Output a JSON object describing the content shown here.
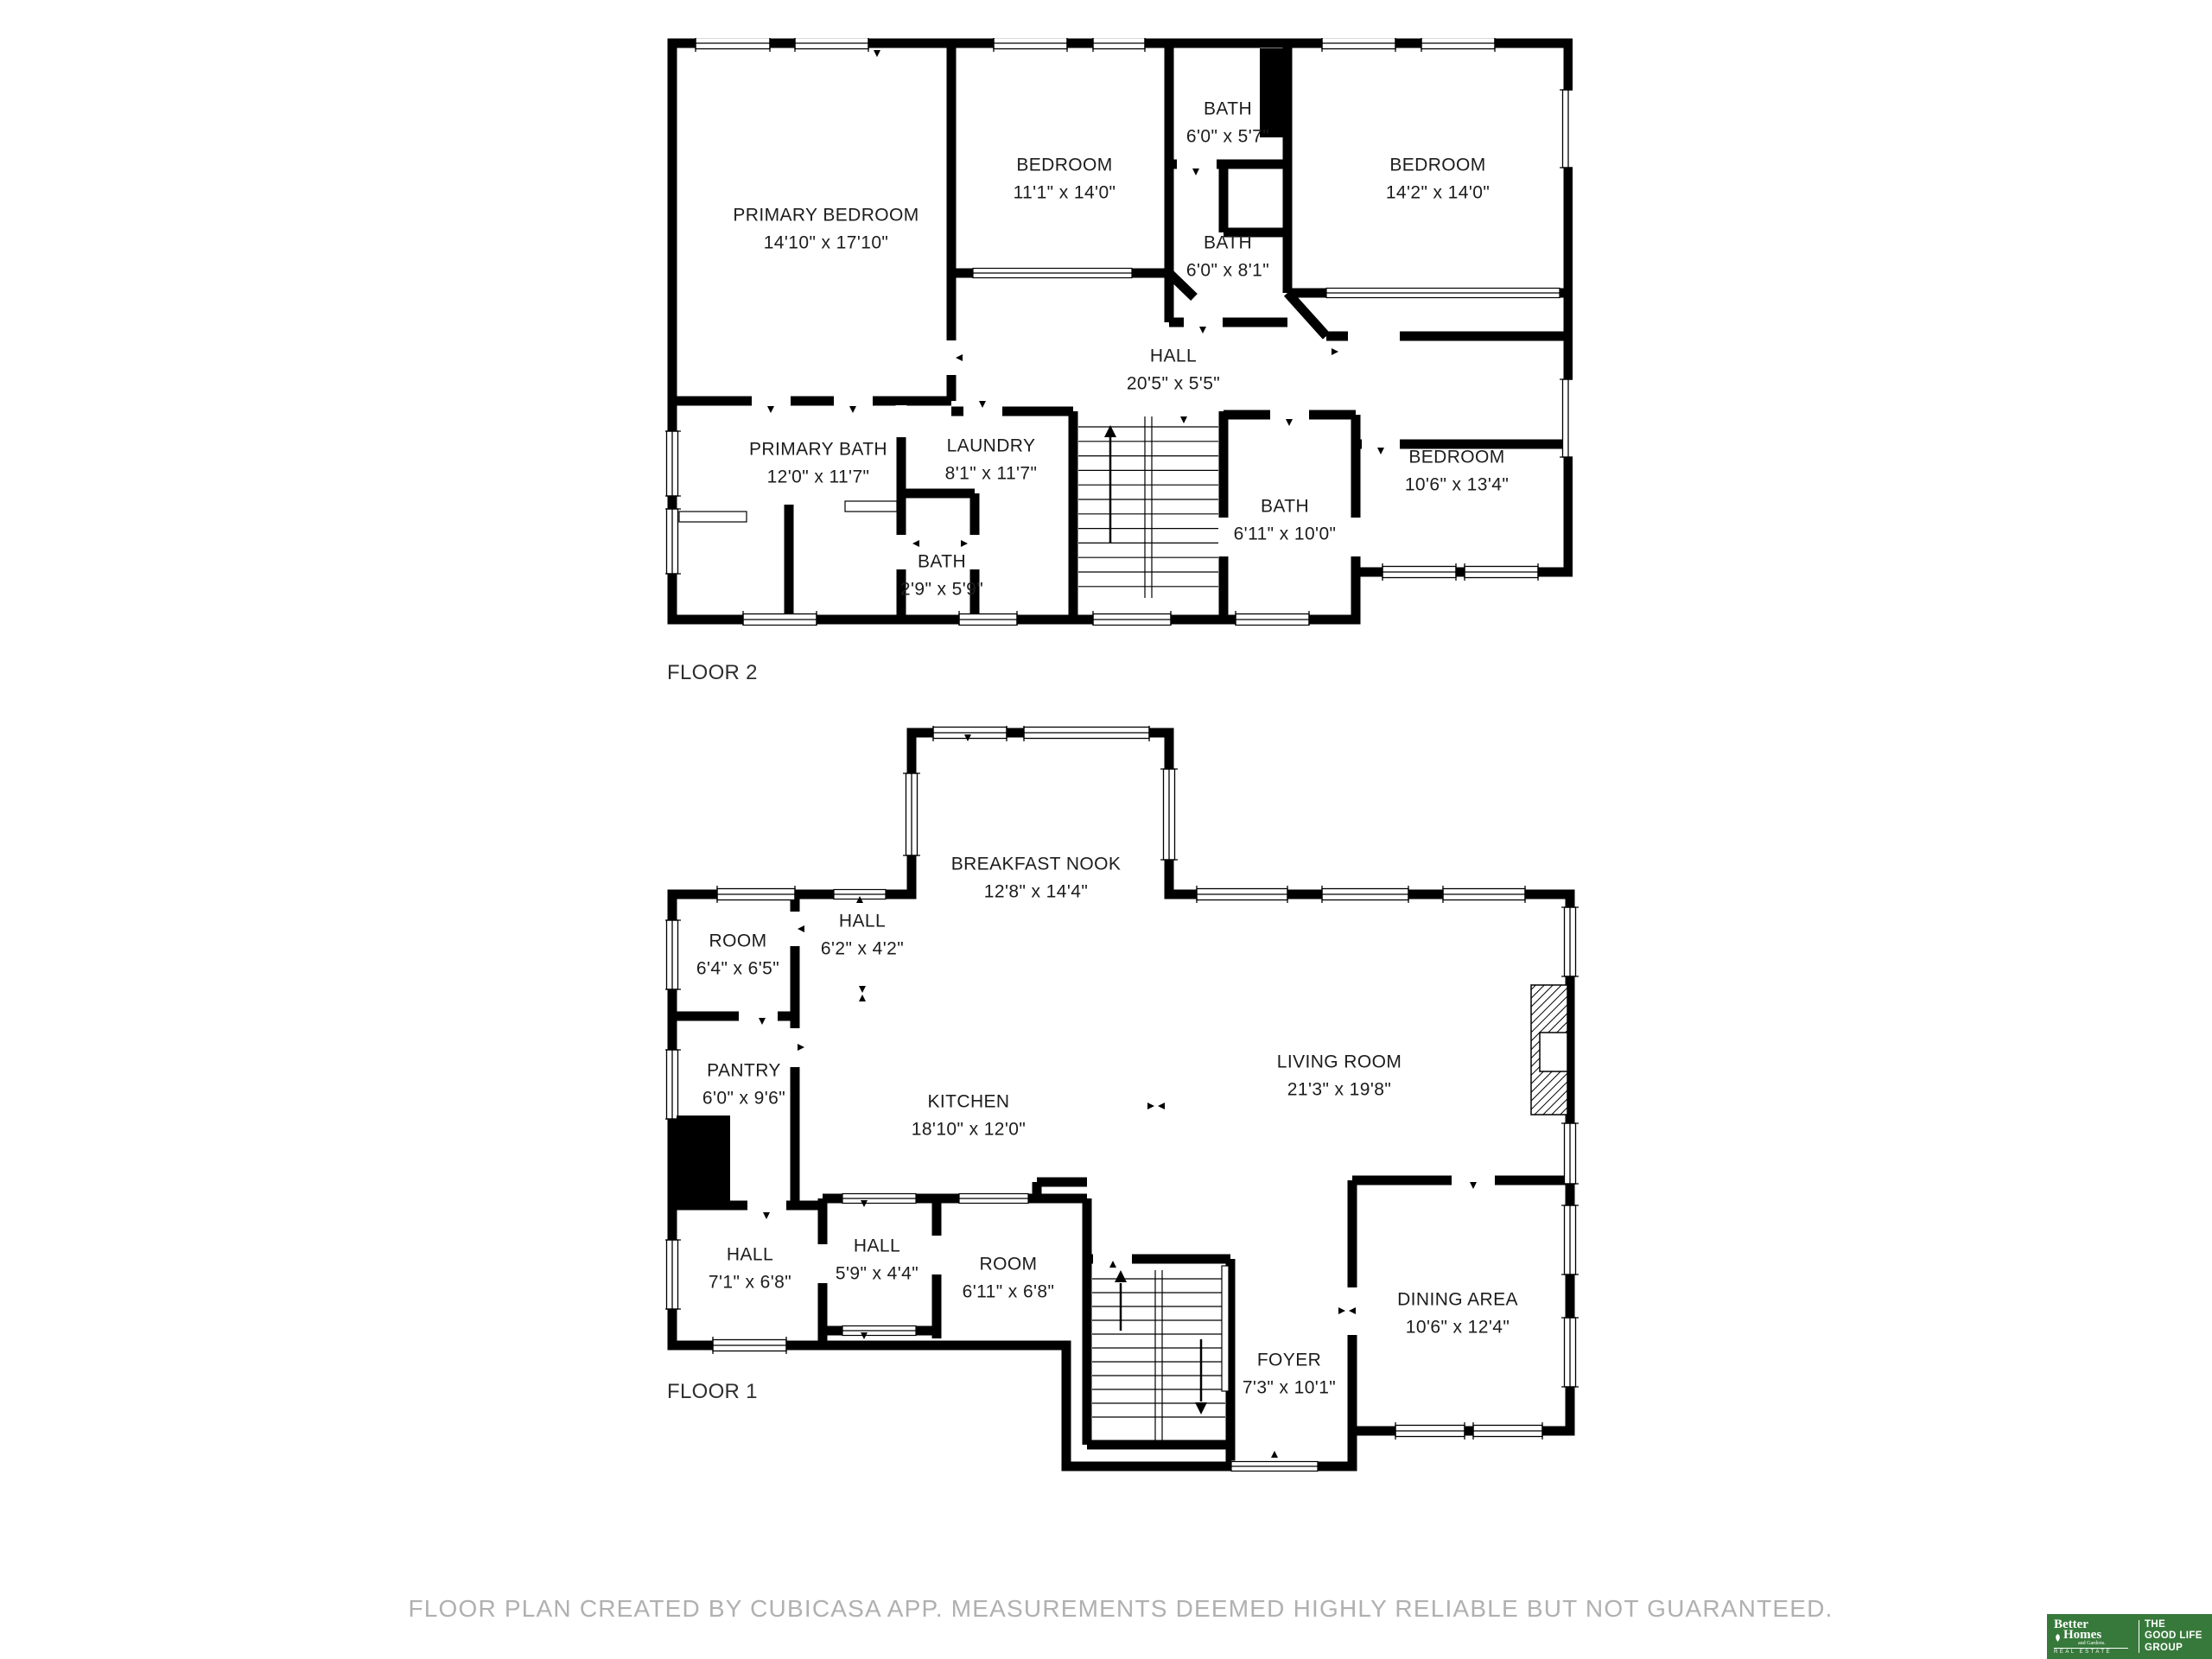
{
  "floors": [
    {
      "label": "FLOOR 2",
      "rooms": [
        {
          "name": "PRIMARY BEDROOM",
          "dims": "14'10\" x 17'10\""
        },
        {
          "name": "BEDROOM",
          "dims": "11'1\" x 14'0\""
        },
        {
          "name": "BATH",
          "dims": "6'0\" x 5'7\""
        },
        {
          "name": "BEDROOM",
          "dims": "14'2\" x 14'0\""
        },
        {
          "name": "BATH",
          "dims": "6'0\" x 8'1\""
        },
        {
          "name": "HALL",
          "dims": "20'5\" x 5'5\""
        },
        {
          "name": "PRIMARY BATH",
          "dims": "12'0\" x 11'7\""
        },
        {
          "name": "LAUNDRY",
          "dims": "8'1\" x 11'7\""
        },
        {
          "name": "BATH",
          "dims": "2'9\" x 5'9\""
        },
        {
          "name": "BATH",
          "dims": "6'11\" x 10'0\""
        },
        {
          "name": "BEDROOM",
          "dims": "10'6\" x 13'4\""
        }
      ]
    },
    {
      "label": "FLOOR 1",
      "rooms": [
        {
          "name": "BREAKFAST NOOK",
          "dims": "12'8\" x 14'4\""
        },
        {
          "name": "ROOM",
          "dims": "6'4\" x 6'5\""
        },
        {
          "name": "HALL",
          "dims": "6'2\" x 4'2\""
        },
        {
          "name": "PANTRY",
          "dims": "6'0\" x 9'6\""
        },
        {
          "name": "KITCHEN",
          "dims": "18'10\" x 12'0\""
        },
        {
          "name": "LIVING ROOM",
          "dims": "21'3\" x 19'8\""
        },
        {
          "name": "HALL",
          "dims": "7'1\" x 6'8\""
        },
        {
          "name": "HALL",
          "dims": "5'9\" x 4'4\""
        },
        {
          "name": "ROOM",
          "dims": "6'11\" x 6'8\""
        },
        {
          "name": "FOYER",
          "dims": "7'3\" x 10'1\""
        },
        {
          "name": "DINING AREA",
          "dims": "10'6\" x 12'4\""
        }
      ]
    }
  ],
  "footer": {
    "disclaimer": "FLOOR PLAN CREATED BY CUBICASA APP. MEASUREMENTS DEEMED HIGHLY RELIABLE BUT NOT GUARANTEED."
  },
  "logo": {
    "brand_line1": "Better",
    "brand_line2": "Homes",
    "brand_line3": "and Gardens.",
    "brand_line4": "REAL ESTATE",
    "group_line1": "THE",
    "group_line2": "GOOD LIFE",
    "group_line3": "GROUP"
  },
  "colors": {
    "wall": "#000000",
    "label_text": "#1c1c1c",
    "footer_text": "#b0b0b0",
    "logo_green": "#37793b",
    "logo_text": "#ffffff"
  }
}
